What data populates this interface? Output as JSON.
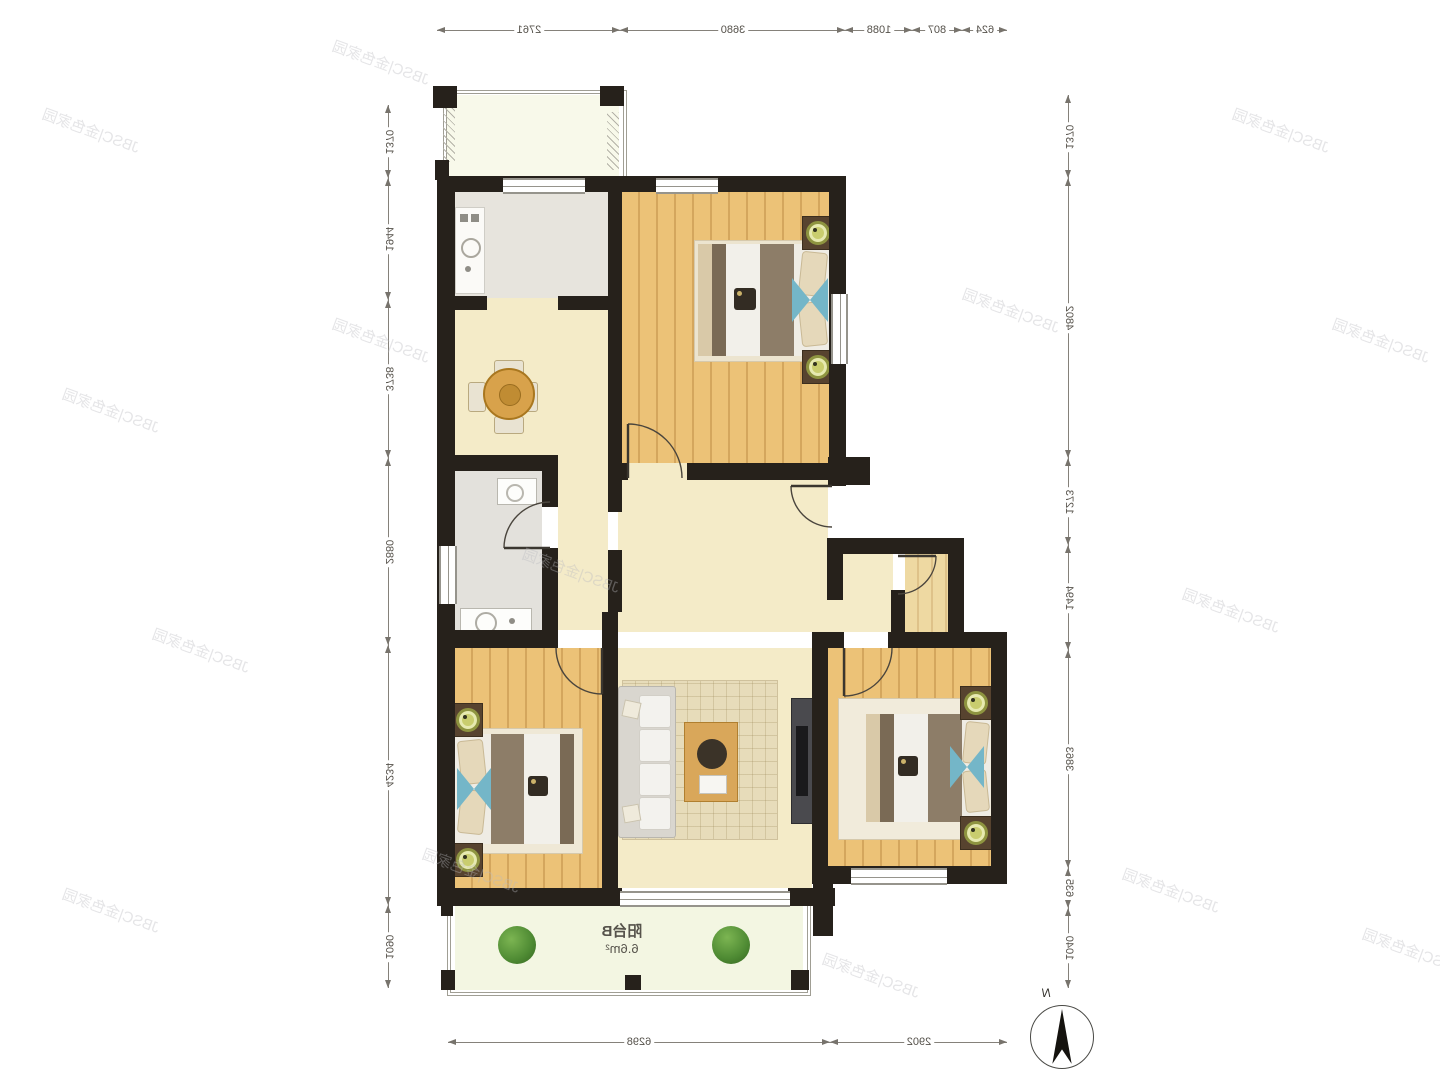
{
  "plan": {
    "balcony_label": {
      "name": "阳台B",
      "area": "6.6m²"
    },
    "compass_label": "N",
    "mirrored": true
  },
  "watermark": {
    "text": "JBSC|金色家园",
    "color": "rgba(186,186,192,0.38)",
    "positions": [
      [
        40,
        120
      ],
      [
        330,
        52
      ],
      [
        1230,
        120
      ],
      [
        60,
        400
      ],
      [
        330,
        330
      ],
      [
        960,
        300
      ],
      [
        1330,
        330
      ],
      [
        150,
        640
      ],
      [
        520,
        560
      ],
      [
        1180,
        600
      ],
      [
        60,
        900
      ],
      [
        420,
        860
      ],
      [
        820,
        965
      ],
      [
        1120,
        880
      ],
      [
        1360,
        940
      ]
    ]
  },
  "dimensions": {
    "top": [
      {
        "label": "2761",
        "from": 437,
        "to": 620
      },
      {
        "label": "3680",
        "from": 620,
        "to": 845
      },
      {
        "label": "1088",
        "from": 845,
        "to": 912
      },
      {
        "label": "807",
        "from": 912,
        "to": 962
      },
      {
        "label": "624",
        "from": 962,
        "to": 1007
      }
    ],
    "bottom": [
      {
        "label": "6298",
        "from": 448,
        "to": 830
      },
      {
        "label": "2902",
        "from": 830,
        "to": 1007
      }
    ],
    "left": [
      {
        "label": "1370",
        "from": 105,
        "to": 178
      },
      {
        "label": "1944",
        "from": 178,
        "to": 300
      },
      {
        "label": "3738",
        "from": 300,
        "to": 458
      },
      {
        "label": "2880",
        "from": 458,
        "to": 645
      },
      {
        "label": "4234",
        "from": 645,
        "to": 905
      },
      {
        "label": "1090",
        "from": 905,
        "to": 988
      }
    ],
    "right": [
      {
        "label": "1370",
        "from": 95,
        "to": 178
      },
      {
        "label": "4802",
        "from": 178,
        "to": 458
      },
      {
        "label": "1273",
        "from": 458,
        "to": 545
      },
      {
        "label": "1494",
        "from": 545,
        "to": 650
      },
      {
        "label": "3863",
        "from": 650,
        "to": 868
      },
      {
        "label": "635",
        "from": 868,
        "to": 908
      },
      {
        "label": "1040",
        "from": 908,
        "to": 988
      }
    ],
    "axis": {
      "top_y": 30,
      "bottom_y": 1042,
      "left_x": 388,
      "right_x": 1068
    }
  },
  "colors": {
    "wall": "#26211b",
    "wood_floor": "#ecc277",
    "beige_floor": "#f4ebc8",
    "kitchen_floor": "#e7e4dd",
    "balcony_floor": "#f3f6e2",
    "accent_blue": "#74b6c8",
    "lamp_green": "#c9cd6e",
    "dimension_text": "#55514a"
  }
}
